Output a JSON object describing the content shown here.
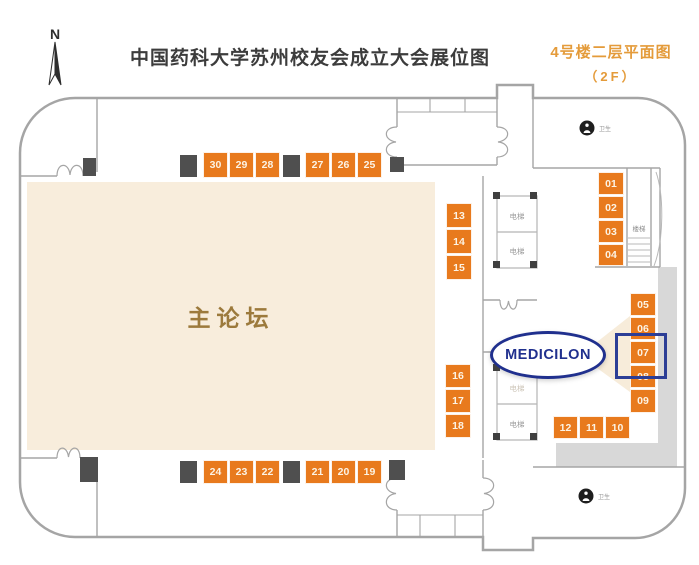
{
  "header": {
    "compass": "N",
    "title": "中国药科大学苏州校友会成立大会展位图",
    "subtitle_line1": "4号楼二层平面图",
    "subtitle_line2": "（2F）"
  },
  "plan": {
    "main_hall_label": "主论坛",
    "elevator_label": "电梯",
    "stairs_label": "楼梯",
    "restroom_label": "卫生",
    "logo_text": "MEDICILON",
    "highlighted_booth": "07",
    "booths": [
      "01",
      "02",
      "03",
      "04",
      "05",
      "06",
      "07",
      "08",
      "09",
      "10",
      "11",
      "12",
      "13",
      "14",
      "15",
      "16",
      "17",
      "18",
      "19",
      "20",
      "21",
      "22",
      "23",
      "24",
      "25",
      "26",
      "27",
      "28",
      "29",
      "30"
    ]
  },
  "colors": {
    "booth_orange": "#e87a1d",
    "highlight_blue": "#2c3e96",
    "subtitle_orange": "#e49b3a",
    "hall_beige": "#f8eddc",
    "hall_label_brown": "#9c7a3c",
    "wall_gray": "#a5a5a5",
    "column_dark": "#4f4f4f",
    "logo_blue": "#20308e"
  }
}
